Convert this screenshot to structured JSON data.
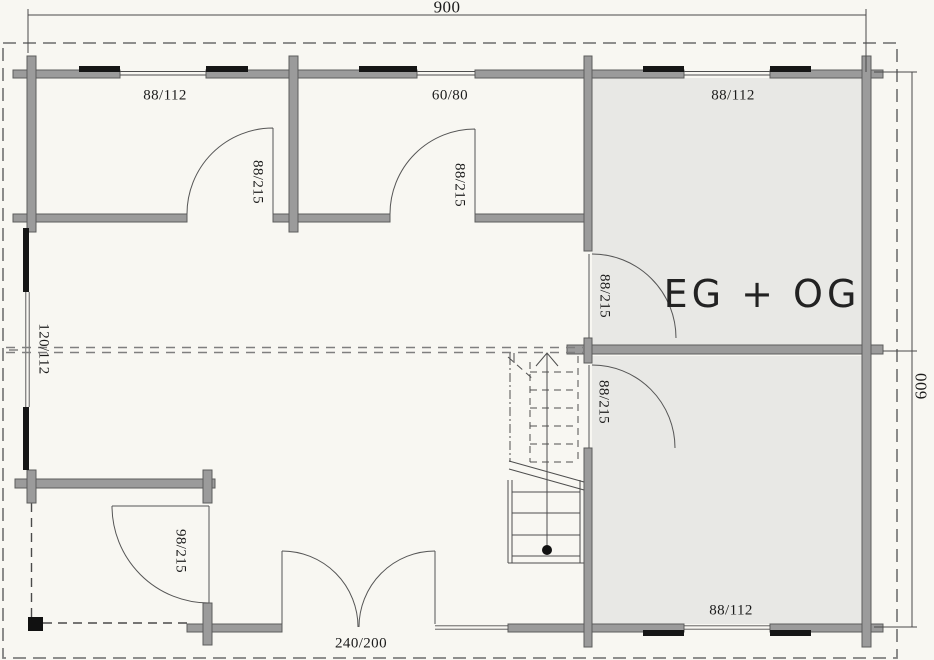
{
  "plan": {
    "title": "Log cabin floor plan",
    "dimensions": {
      "overall_width": "900",
      "overall_height": "600"
    },
    "room_label": "EG + OG",
    "windows": {
      "top_left": "88/112",
      "top_middle": "60/80",
      "top_right": "88/112",
      "left": "120/112",
      "bottom_right": "88/112"
    },
    "doors": {
      "room1": "88/215",
      "room2": "88/215",
      "two_story_upper": "88/215",
      "two_story_lower": "88/215",
      "storage": "98/215",
      "terrace_double": "240/200"
    },
    "colors": {
      "wall": "#9b9b9b",
      "wall-outline": "#5c5c5c",
      "window": "#161616",
      "room-fill": "#e8e8e5",
      "dash": "#7f7f7f",
      "line": "#4e4e4e",
      "background": "#f8f7f2"
    }
  }
}
